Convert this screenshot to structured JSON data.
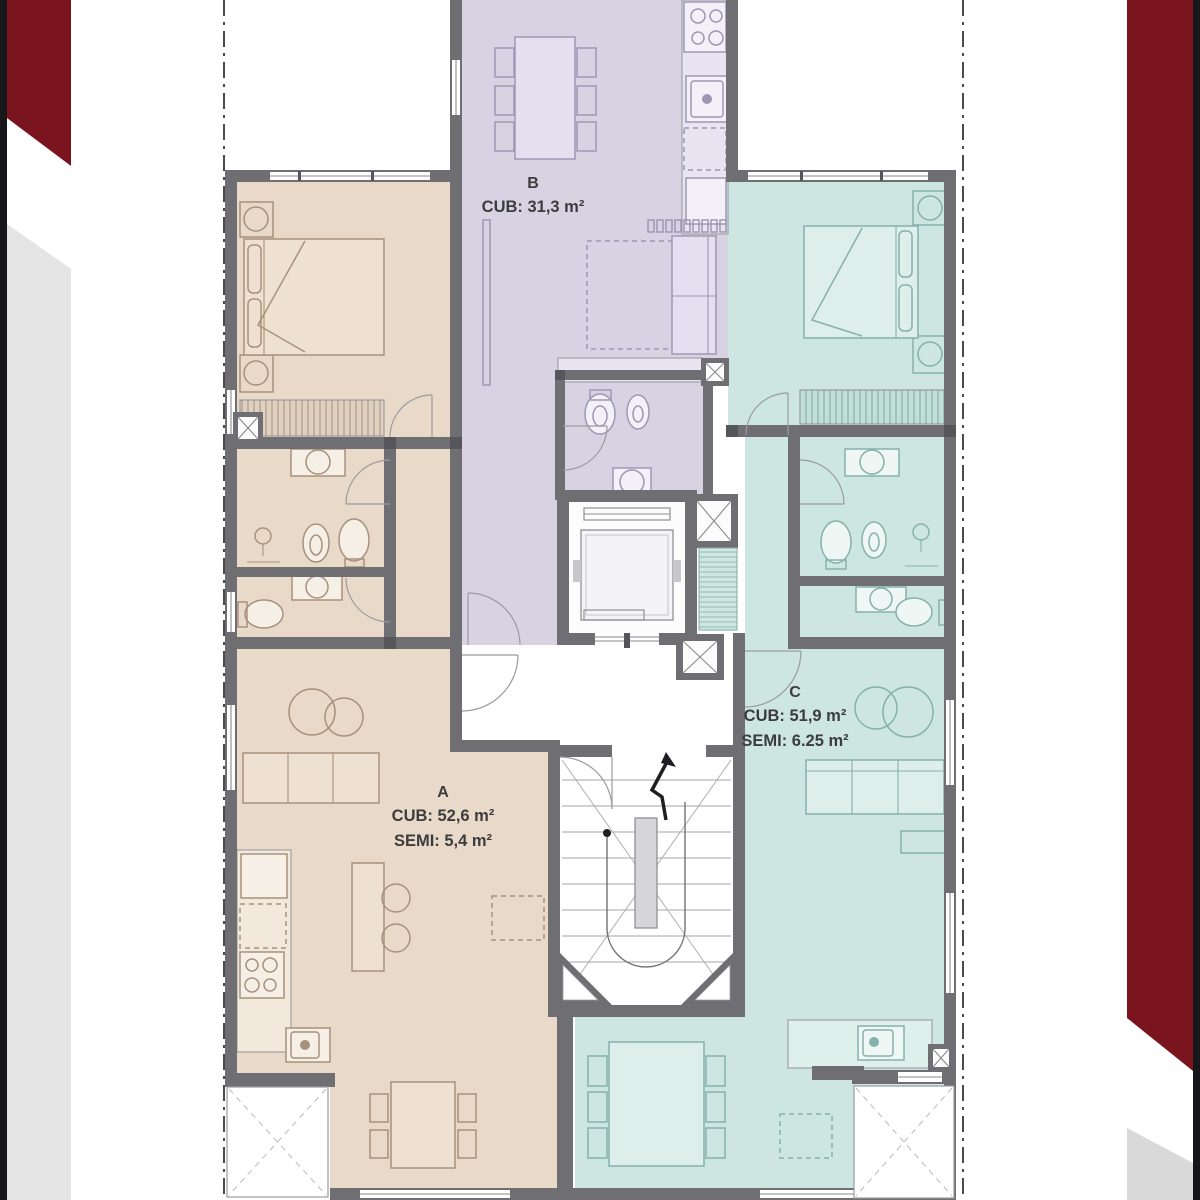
{
  "units": [
    {
      "id": "A",
      "label": "A",
      "lines": [
        "CUB: 52,6 m²",
        "SEMI: 5,4 m²"
      ],
      "fill": "#e9d9c9"
    },
    {
      "id": "B",
      "label": "B",
      "lines": [
        "CUB: 31,3 m²"
      ],
      "fill": "#d8d2e2"
    },
    {
      "id": "C",
      "label": "C",
      "lines": [
        "CUB: 51,9 m²",
        "SEMI: 6.25 m²"
      ],
      "fill": "#cde6e2"
    }
  ],
  "colors": {
    "unit-a": "#e9d9c9",
    "unit-b": "#d8d2e2",
    "unit-c": "#cde6e2",
    "counter-a": "#f2e8db",
    "counter-b": "#e9e4f1",
    "counter-c": "#def0ec",
    "line-a": "#a8917c",
    "line-b": "#9e97b4",
    "line-c": "#85b1ab",
    "wall": "#6e6e73",
    "accent-red": "#7a1520",
    "edge-black": "#17171a",
    "band-gray-left": "#e4e4e4",
    "band-gray-right": "#d9d9d9",
    "text": "#3c3c3e"
  }
}
